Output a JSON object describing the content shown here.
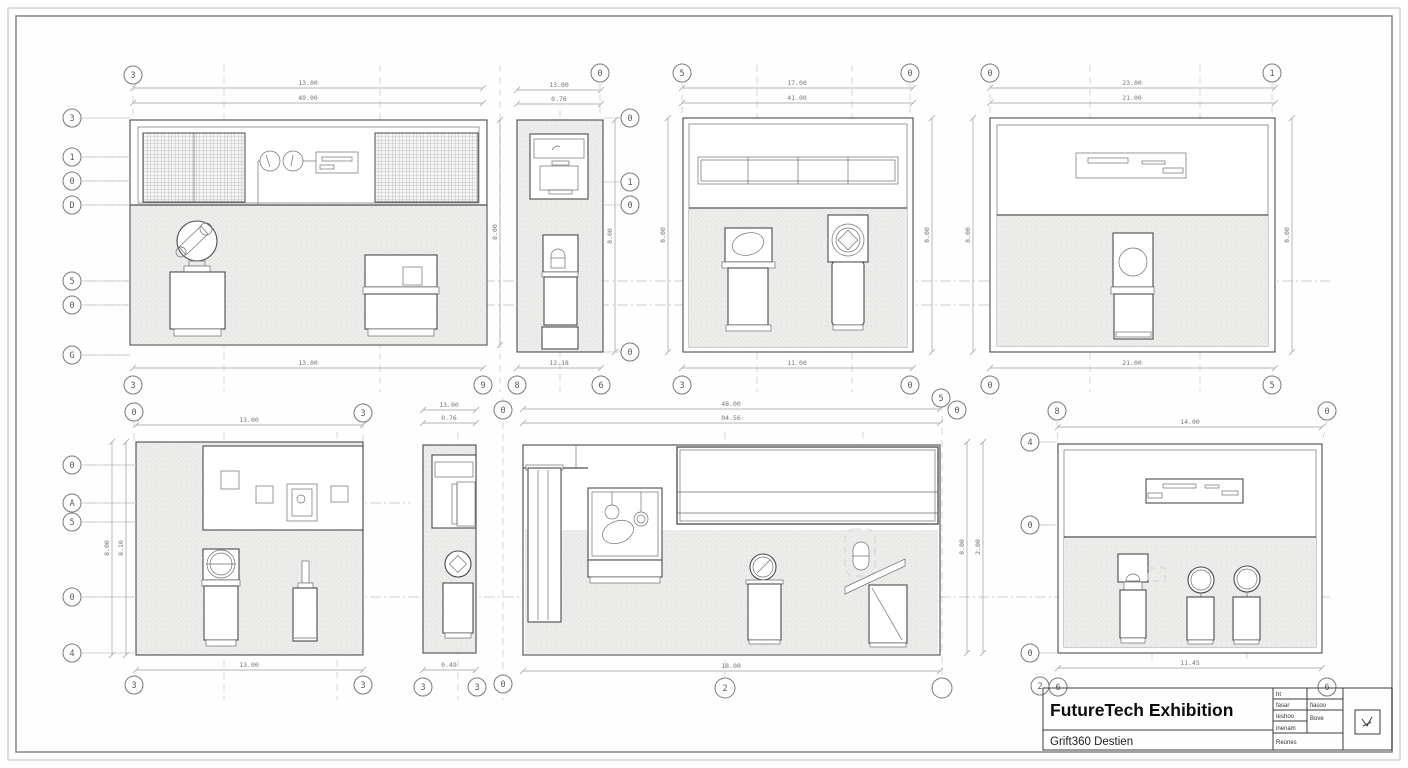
{
  "colors": {
    "ink": "#4b4b4b",
    "dim_line": "#9b9b9b",
    "floor_fill": "#e9e9e8",
    "paper": "#fefefe",
    "border": "#6b6b6b",
    "title_ink": "#0c0c0c"
  },
  "title_block": {
    "project_title": "FutureTech Exhibition",
    "project_subtitle": "Grift360 Destien",
    "info_rows_left": [
      "ht",
      "fasar",
      "teshoo",
      "inenam",
      "Reones"
    ],
    "info_rows_right": [
      "fiasoo",
      "Bove"
    ],
    "stamp_icon": "check-mark-stamp-icon"
  },
  "panels": {
    "a": {
      "dim_top1": "13.00",
      "dim_top2": "49.00",
      "dim_bottom": "13.00",
      "dim_right": "8.00",
      "bub_top": [
        "3"
      ],
      "bub_left": [
        "3",
        "1",
        "0",
        "D",
        "5",
        "0",
        "G"
      ],
      "bub_bottom": [
        "3",
        "9"
      ]
    },
    "b": {
      "dim_top1": "13.00",
      "dim_top2": "0.76",
      "dim_bottom": "12.18",
      "dim_right": "8.00",
      "bub_top": [
        "0"
      ],
      "bub_right": [
        "0",
        "1",
        "0",
        "0"
      ],
      "bub_bottom": [
        "8",
        "6"
      ]
    },
    "c": {
      "dim_top1": "17.00",
      "dim_top2": "41.00",
      "dim_bottom": "11.00",
      "dim_left": "8.00",
      "dim_right": "8.00",
      "bub_top": [
        "5",
        "0"
      ],
      "bub_bottom": [
        "3",
        "0"
      ]
    },
    "d": {
      "dim_top1": "23.00",
      "dim_top2": "21.00",
      "dim_bottom": "21.00",
      "dim_left": "8.00",
      "dim_right": "8.00",
      "bub_top": [
        "0",
        "1"
      ],
      "bub_bottom": [
        "0",
        "5"
      ]
    },
    "e": {
      "dim_top": "13.00",
      "dim_bottom": "13.00",
      "dim_left1": "8.00",
      "dim_left2": "8.10",
      "bub_top": [
        "0",
        "3"
      ],
      "bub_left": [
        "0",
        "A",
        "5",
        "0",
        "4"
      ],
      "bub_bottom": [
        "3",
        "3"
      ]
    },
    "f": {
      "dim_top1": "13.00",
      "dim_top2": "0.76",
      "dim_bottom": "0.49",
      "bub_top": [
        "0"
      ],
      "bub_bottom": [
        "3",
        "3",
        "0"
      ]
    },
    "g": {
      "dim_top1": "48.00",
      "dim_top2": "04.56",
      "dim_bottom": "18.00",
      "dim_right1": "8.00",
      "dim_right2": "2.00",
      "bub_top": [
        "5",
        "0"
      ],
      "bub_bottom": [
        "2"
      ]
    },
    "h": {
      "dim_top": "14.00",
      "dim_bottom": "11.45",
      "bub_top": [
        "8",
        "0"
      ],
      "bub_left": [
        "4",
        "0",
        "0"
      ],
      "bub_bottom": [
        "2",
        "6",
        "6"
      ]
    }
  }
}
